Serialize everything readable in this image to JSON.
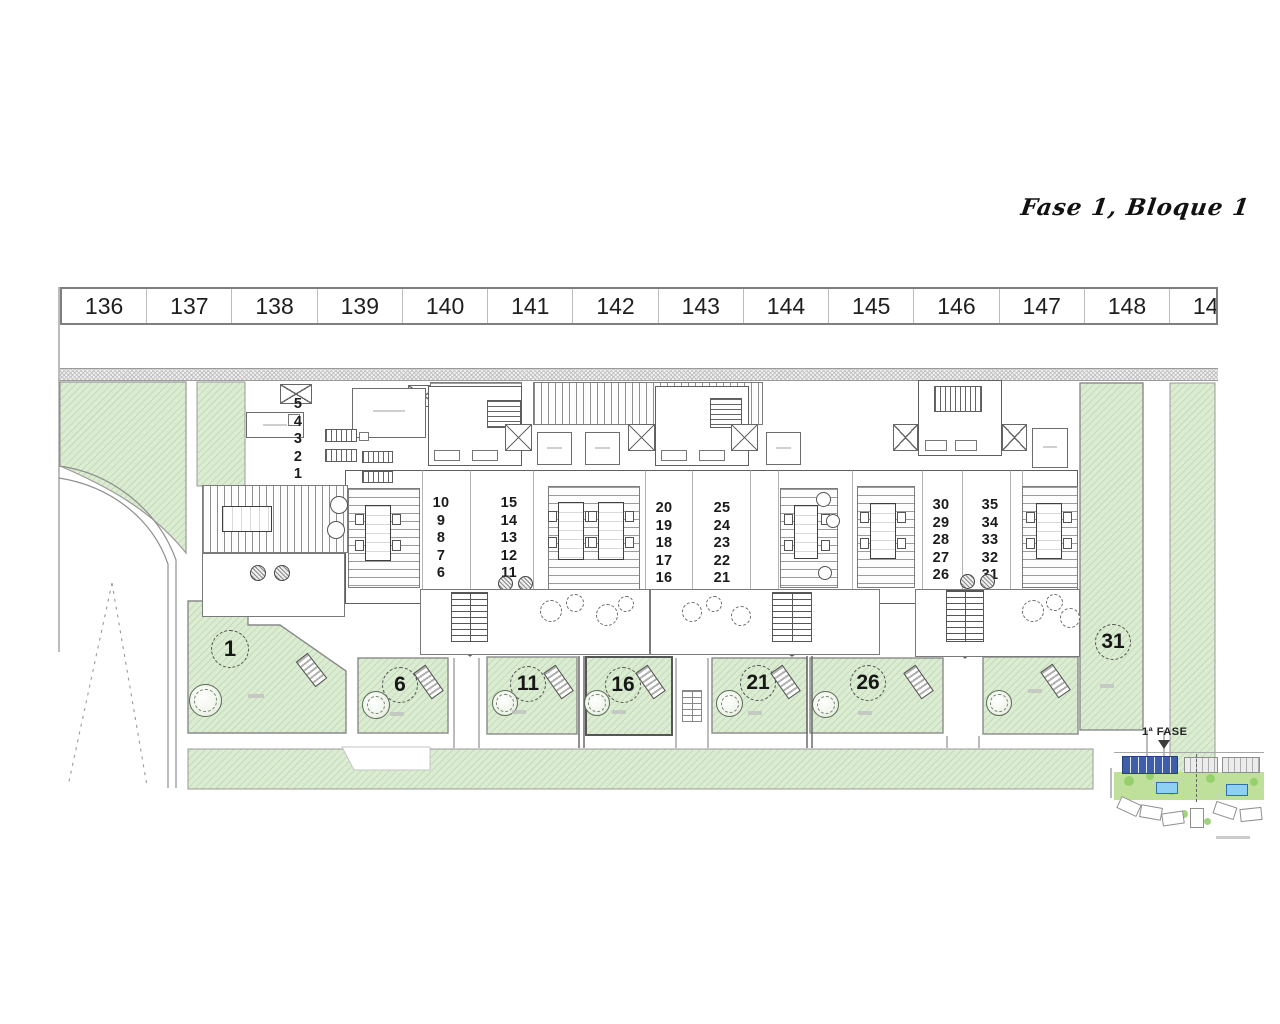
{
  "title": "Fase 1, Bloque 1",
  "parking": {
    "spaces": [
      "136",
      "137",
      "138",
      "139",
      "140",
      "141",
      "142",
      "143",
      "144",
      "145",
      "146",
      "147",
      "148",
      "149"
    ]
  },
  "building": {
    "left_unit_stack": [
      "5",
      "4",
      "3",
      "2",
      "1"
    ],
    "unit_stacks": [
      [
        "10",
        "9",
        "8",
        "7",
        "6"
      ],
      [
        "15",
        "14",
        "13",
        "12",
        "11"
      ],
      [
        "20",
        "19",
        "18",
        "17",
        "16"
      ],
      [
        "25",
        "24",
        "23",
        "22",
        "21"
      ],
      [
        "30",
        "29",
        "28",
        "27",
        "26"
      ],
      [
        "35",
        "34",
        "33",
        "32",
        "31"
      ]
    ]
  },
  "gardens": {
    "plot_labels": [
      "1",
      "6",
      "11",
      "16",
      "21",
      "26",
      "31"
    ]
  },
  "minimap": {
    "label": "1ª FASE"
  },
  "colors": {
    "garden_green": "#dbecd2",
    "garden_hatch": "#b2d2a6",
    "line_gray": "#8a8a8a",
    "phase_block_blue": "#3f5ea9",
    "pool_blue": "#8ed0f2"
  }
}
